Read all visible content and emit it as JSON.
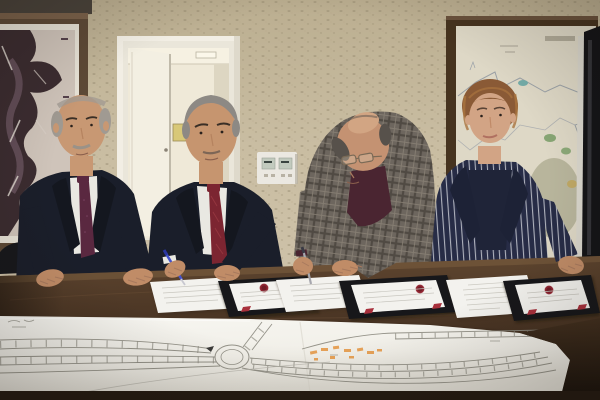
{
  "scene": {
    "type": "photograph",
    "description": "Indoor signing ceremony: four officials stand behind a dark wooden conference table signing protocol documents; a large road-plan engineering drawing with a roundabout and orange highlighter marks lies across the table foreground.",
    "people": [
      {
        "id": "man-left",
        "hair": "gray, balding",
        "attire": "dark navy suit, white shirt, maroon patterned tie",
        "pose": "standing, both hands resting on table"
      },
      {
        "id": "man-signing-left",
        "hair": "gray",
        "attire": "dark navy suit, white shirt, red striped tie",
        "pose": "signing a document",
        "holding": "blue pen"
      },
      {
        "id": "man-signing-right",
        "hair": "balding, dark gray fringe",
        "attire": "gray plaid jacket, dark maroon shirt, wire glasses",
        "pose": "bent over, signing a document",
        "holding": "gray pen"
      },
      {
        "id": "woman-right",
        "hair": "short auburn",
        "attire": "navy pinstripe blazer, dark navy top",
        "pose": "standing, left hand on table"
      }
    ],
    "objects": [
      {
        "id": "framed-aerial-photo",
        "where": "left wall",
        "look": "dark jagged satellite image in brown wooden frame"
      },
      {
        "id": "open-door",
        "where": "left-center wall",
        "look": "white door open to a bright hallway with ceiling light, small yellow sign and small picture frame inside"
      },
      {
        "id": "thermostat-panel",
        "where": "wall between first two men",
        "look": "white dual-display control panel"
      },
      {
        "id": "framed-wall-map",
        "where": "right wall",
        "look": "cream city map with gray boundary lines, green patches and small teal lake, dark brown frame"
      },
      {
        "id": "screen-edge",
        "where": "far right edge",
        "look": "dark presentation screen edge with light rim"
      },
      {
        "id": "black-chair",
        "where": "far left at table",
        "look": "dark chair back"
      },
      {
        "id": "conference-table",
        "look": "dark walnut wood"
      },
      {
        "id": "documents",
        "count": 6,
        "look": "three loose white sheets and three white documents in black folders with red wax seals and red ribbon corners"
      },
      {
        "id": "road-plan-drawing",
        "look": "large white sheet, pencil-drawn multi-lane road converging on a roundabout, branch roads, tick marks, orange highlighter annotations"
      }
    ]
  },
  "colors": {
    "wall": "#c7bb9f",
    "wallShadow": "#9e9277",
    "pictureFrame": "#5d4936",
    "pictureMat": "#e7e2d6",
    "pictureDark": "#3b2c30",
    "doorFrame": "#eae6da",
    "doorLeaf": "#f3efe2",
    "hallway": "#efe9d8",
    "hallLight": "#fbf7ea",
    "thermo": "#ebe8e1",
    "thermoScreen": "#c2cabe",
    "mapFrame": "#46331f",
    "mapPaper": "#ded8c6",
    "mapLine": "#8e96a0",
    "mapGreen": "#7da06a",
    "mapOlive": "#99997a",
    "mapTeal": "#74aca8",
    "screenBlack": "#141417",
    "screenEdge": "#d9d6cc",
    "chair": "#17181c",
    "suitNavy": "#1a1e2a",
    "shirt": "#e9e8e2",
    "tie1": "#5a2840",
    "tie2": "#7c2531",
    "plaidBase": "#6d665e",
    "maroonShirt": "#4a2531",
    "blazerNavy": "#272c46",
    "blazerDark": "#1f2438",
    "hairGray1": "#a09a92",
    "hairGray2": "#8d8984",
    "hairGray3": "#57514b",
    "hairAuburn": "#8a5a36",
    "skin1": "#c89873",
    "skin2": "#c6956f",
    "skin3": "#c49272",
    "skinW": "#d2a485",
    "hand": "#c08c67",
    "table1": "#5e452f",
    "table2": "#33251a",
    "tableEdgeHi": "#7b5e40",
    "folder": "#17171a",
    "folderTrim": "#7e222c",
    "seal": "#8d2430",
    "docWhite": "#f3f2ee",
    "docLine": "#c9c7c0",
    "penBlue": "#4452cc",
    "penSilver": "#a7a7ae",
    "paper": "#f4f3ee",
    "paperShade": "#e2dfd6",
    "pencil": "#8b897f",
    "orange": "#e6953f"
  }
}
